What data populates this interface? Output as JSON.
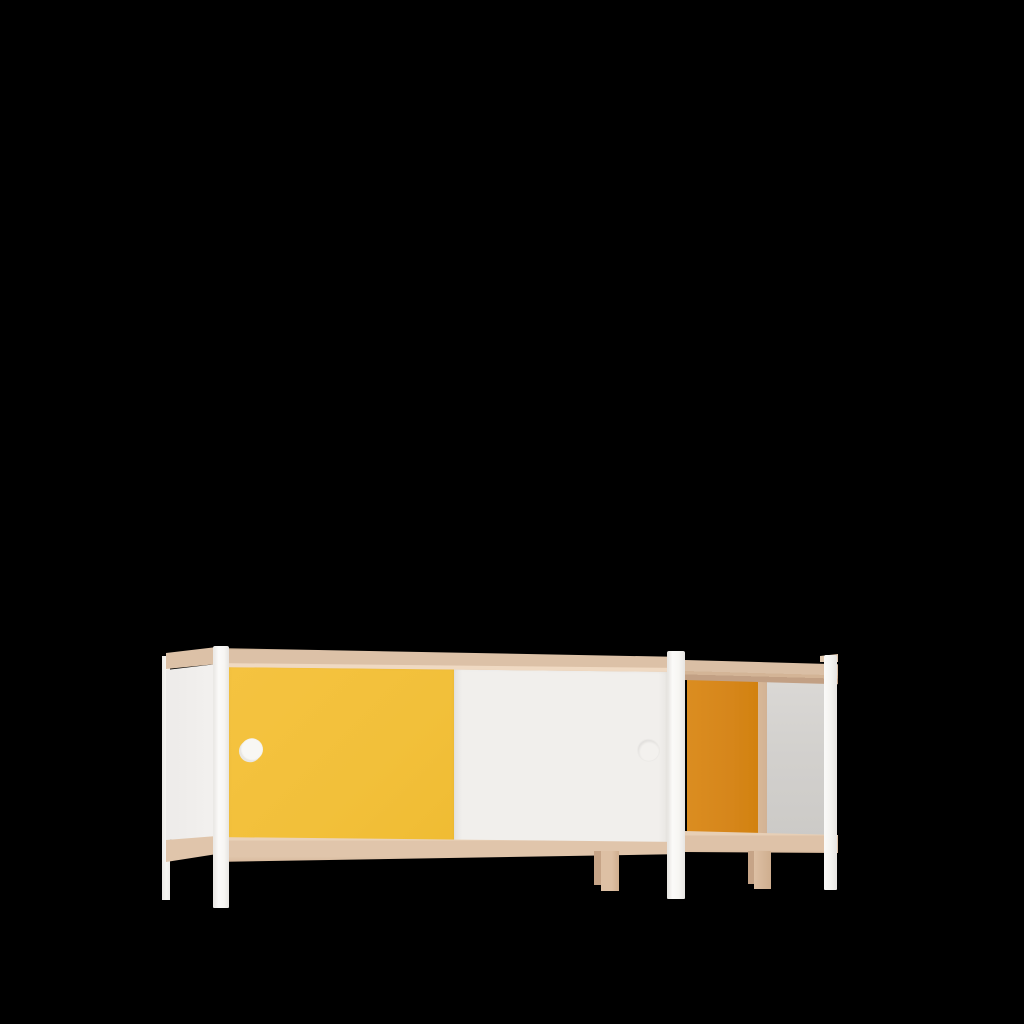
{
  "scene": {
    "kind": "3d-product-render",
    "subject": "low sideboard / credenza with sliding doors",
    "description": "Three-quarter front view of a low rectangular sideboard with a beech wood frame, white round-edged legs and posts, a yellow sliding door and a white sliding door each with a round recessed finger-pull, plus an open end compartment showing an orange back panel and grey interior side panel, rendered on a plain black background.",
    "background_color": "#000000"
  },
  "palette": {
    "bg": "#000000",
    "wood-face": "#DCC1A7",
    "wood-top-light": "#EFD9C2",
    "wood-edge-dark": "#C9AC90",
    "wood-underside": "#C2A084",
    "wood-bottom": "#E0C5AB",
    "wood-divider": "#D2B294",
    "wood-leg": "#DDC0A4",
    "wood-leg-dark": "#C6A487",
    "door-yellow": "#F2C03A",
    "door-white": "#F1EFEC",
    "panel-white": "#F3F1EF",
    "panel-orange": "#D6861B",
    "interior-gray": "#D3D1CE",
    "post-white": "#F7F6F3",
    "post-highlight": "#FBFAF9",
    "post-shadow": "#E7E5E2",
    "handle-white": "#F8F7F4",
    "handle-shadow": "#E9E7E3"
  },
  "labels": {
    "scene": "Product render of a sideboard on a black background",
    "sideboard": "Sideboard with two sliding doors and an open end compartment",
    "yellow_door": "Yellow sliding door",
    "white_door": "White sliding door",
    "yellow_door_handle": "Round recessed handle on yellow door",
    "white_door_handle": "Round recessed handle on white door",
    "top_rail": "Beech wood top rail",
    "bottom_rail": "Beech wood bottom rail",
    "left_end_panel": "White left end panel with wood trim",
    "open_compartment_back": "Orange back panel of open compartment",
    "open_compartment_side": "Grey interior side panel of open compartment",
    "wood_divider": "Wood divider post of open compartment",
    "white_leg": "White leg",
    "wood_leg": "Wood leg",
    "white_post": "White frame post"
  }
}
